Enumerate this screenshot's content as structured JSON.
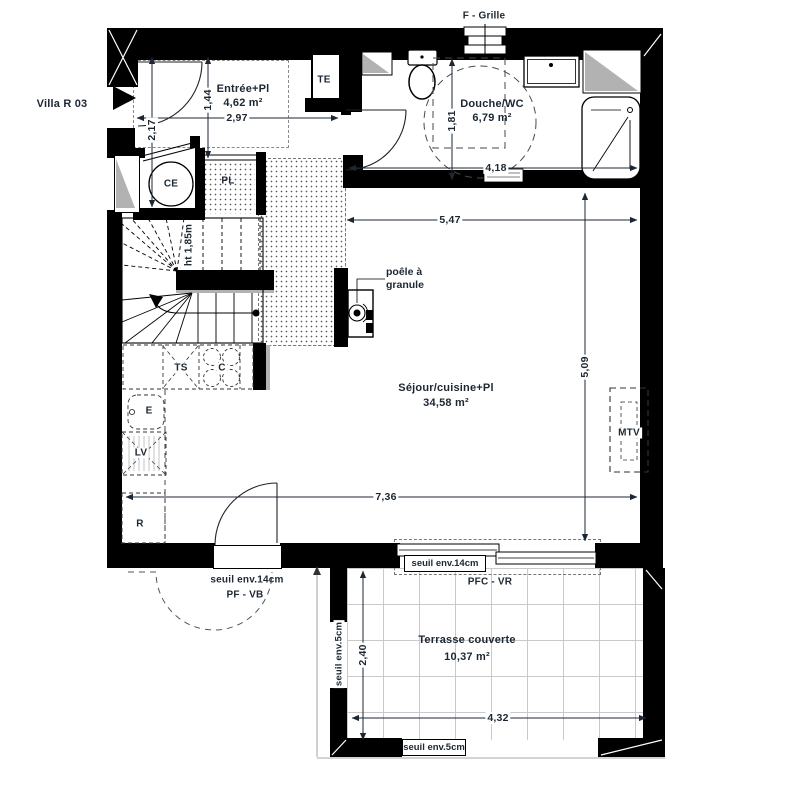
{
  "title": "Villa R 03",
  "colors": {
    "wall": "#000000",
    "text": "#1c2733",
    "shaft_gray": "#b2b2b2"
  },
  "rooms": {
    "entree": {
      "name": "Entrée+Pl",
      "area": "4,62 m²"
    },
    "douche": {
      "name": "Douche/WC",
      "area": "6,79 m²"
    },
    "sejour": {
      "name": "Séjour/cuisine+Pl",
      "area": "34,58 m²"
    },
    "terrasse": {
      "name": "Terrasse couverte",
      "area": "10,37 m²"
    }
  },
  "equipment": {
    "te": "TE",
    "ce": "CE",
    "pl": "PL",
    "ts": "TS",
    "cooktop": "C",
    "evier": "E",
    "lave_vaisselle": "LV",
    "frigo": "R",
    "mtv": "MTV",
    "stove_line1": "poêle à",
    "stove_line2": "granule",
    "grille": "F - Grille",
    "stair_height": "ht 1,85m"
  },
  "dimensions": {
    "entree_width": "2,97",
    "entree_depth": "1,44",
    "entree_side": "2,17",
    "douche_depth": "1,81",
    "douche_width": "4,18",
    "sejour_width_top": "5,47",
    "sejour_height": "5,09",
    "sejour_width_bottom": "7,36",
    "terrasse_depth": "2,40",
    "terrasse_width": "4,32"
  },
  "thresholds": {
    "pf_vb_seuil": "seuil env.14cm",
    "pf_vb": "PF - VB",
    "pfc_vr_seuil": "seuil env.14cm",
    "pfc_vr": "PFC - VR",
    "terrasse_left_seuil": "seuil env.5cm",
    "terrasse_bottom_seuil": "seuil env.5cm"
  }
}
